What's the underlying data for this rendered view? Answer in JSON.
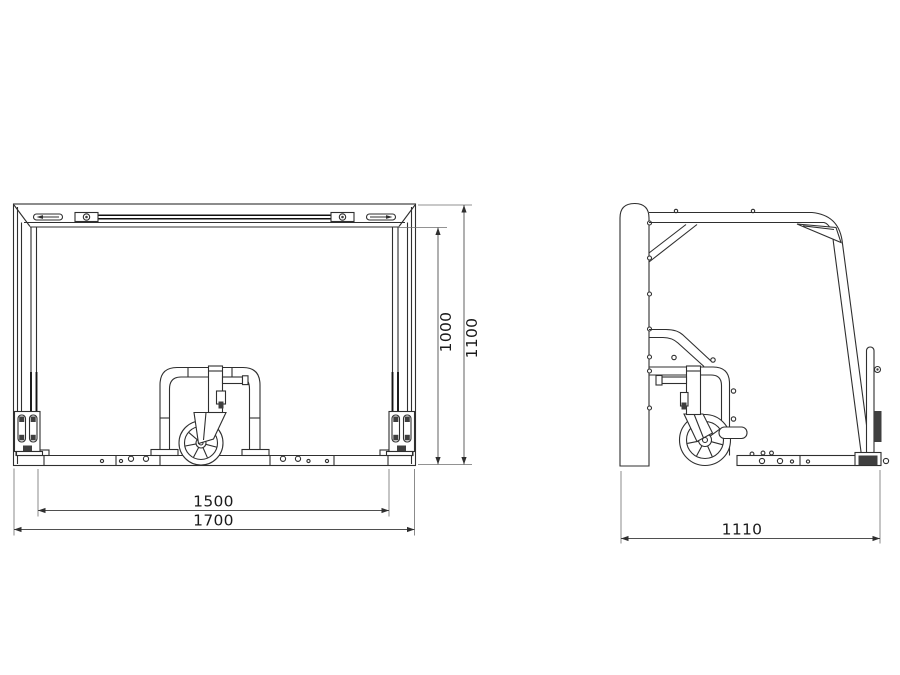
{
  "drawing": {
    "type": "technical-2d-drawing",
    "subject": "wheeled-frame-trolley",
    "colors": {
      "background": "#ffffff",
      "line": "#2f2f2f",
      "dimension": "#4f4f4f",
      "text": "#1b1b1b"
    },
    "views": {
      "front": {
        "label": "front-view",
        "dims": {
          "inner_height": "1000",
          "overall_height": "1100",
          "inner_width": "1500",
          "overall_width": "1700"
        }
      },
      "side": {
        "label": "side-view",
        "dims": {
          "overall_depth": "1110"
        }
      }
    }
  }
}
